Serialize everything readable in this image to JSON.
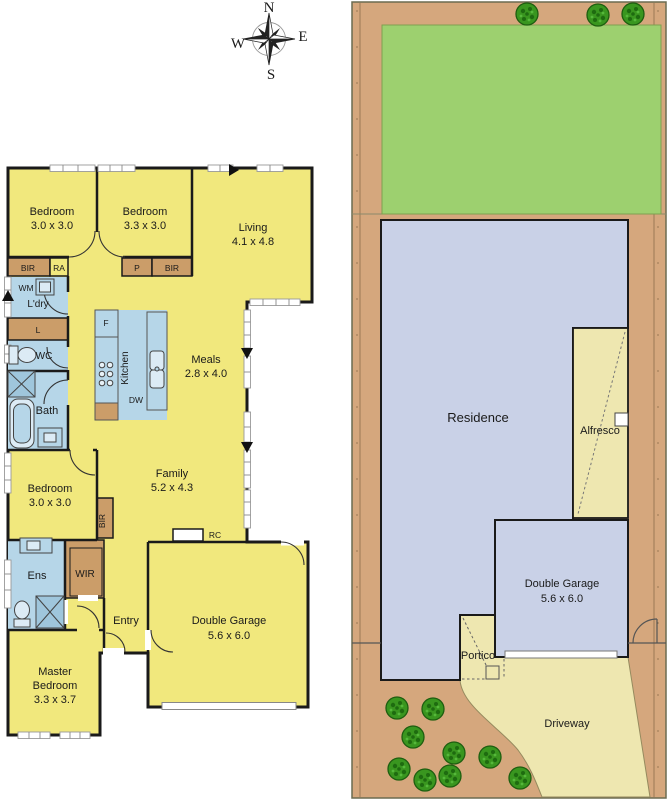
{
  "title": "Floor plan and site plan",
  "compass": {
    "north": "N",
    "east": "E",
    "south": "S",
    "west": "W"
  },
  "floorplan": {
    "bedroom1": {
      "name": "Bedroom",
      "dims": "3.0 x 3.0"
    },
    "bedroom2": {
      "name": "Bedroom",
      "dims": "3.3 x 3.0"
    },
    "living": {
      "name": "Living",
      "dims": "4.1 x 4.8"
    },
    "meals": {
      "name": "Meals",
      "dims": "2.8 x 4.0"
    },
    "family": {
      "name": "Family",
      "dims": "5.2 x 4.3"
    },
    "bedroom3": {
      "name": "Bedroom",
      "dims": "3.0 x 3.0"
    },
    "master_bedroom": {
      "name_line1": "Master",
      "name_line2": "Bedroom",
      "dims": "3.3 x 3.7"
    },
    "garage": {
      "name": "Double Garage",
      "dims": "5.6 x 6.0"
    },
    "kitchen": {
      "name": "Kitchen"
    },
    "laundry": {
      "name": "L'dry"
    },
    "wc": {
      "name": "WC"
    },
    "bath": {
      "name": "Bath"
    },
    "ens": {
      "name": "Ens"
    },
    "wir": {
      "name": "WIR"
    },
    "entry": {
      "name": "Entry"
    },
    "fixtures": {
      "bir": "BIR",
      "ra": "RA",
      "pantry": "P",
      "wm": "WM",
      "linen": "L",
      "fridge": "F",
      "dishwasher": "DW",
      "rc": "RC"
    }
  },
  "siteplan": {
    "residence": "Residence",
    "alfresco": "Alfresco",
    "garage": {
      "name": "Double Garage",
      "dims": "5.6 x 6.0"
    },
    "portico": "Portico",
    "driveway": "Driveway"
  },
  "colors": {
    "room_fill": "#F1E87D",
    "wet_area_fill": "#B6D6E8",
    "joinery_fill": "#CB9D69",
    "wall": "#1A1A1A",
    "site_ground": "#D5A77D",
    "lawn": "#9DD06F",
    "residence_fill": "#C9D1E7",
    "paving_fill": "#EEE7B0",
    "tree_fill": "#39961F"
  }
}
